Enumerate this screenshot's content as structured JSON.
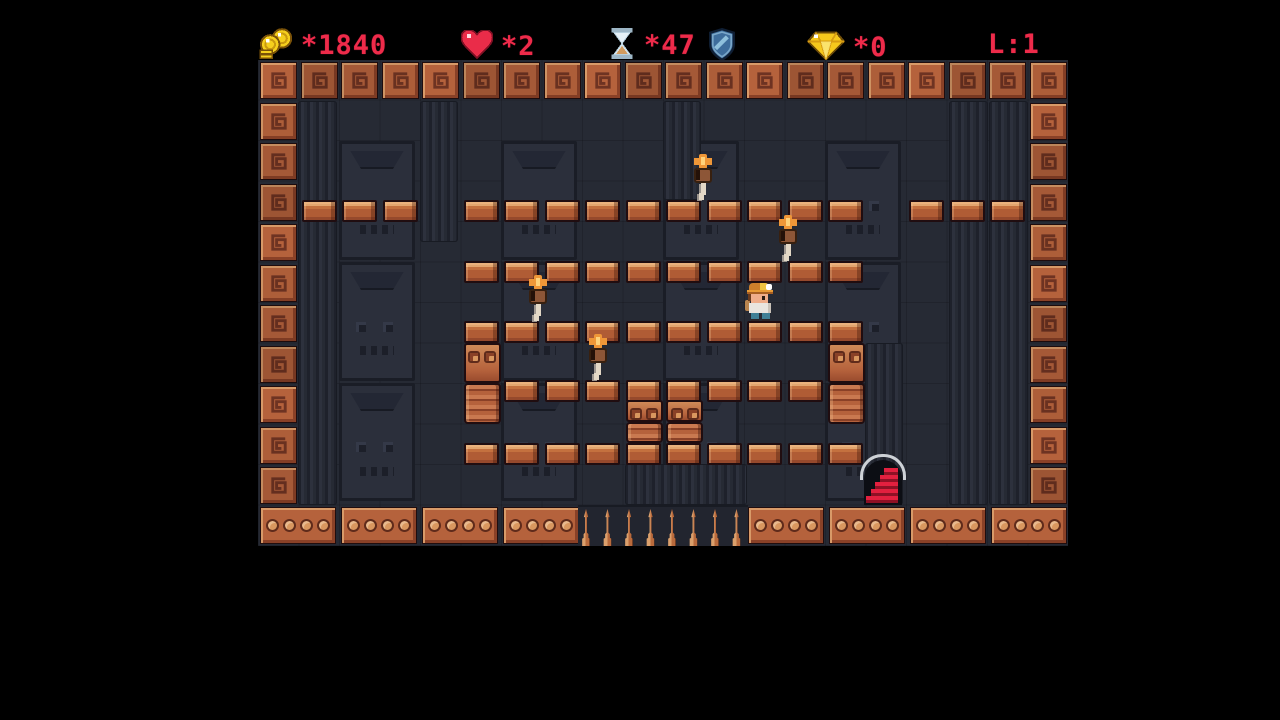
{
  "title": "temple platformer level screen",
  "hud": {
    "coins": {
      "icon": "coins-icon",
      "value": "*1840"
    },
    "lives": {
      "icon": "heart-icon",
      "value": "*2"
    },
    "time": {
      "icon": "hourglass-icon",
      "value": "*47"
    },
    "shield": {
      "icon": "shield-icon"
    },
    "gems": {
      "icon": "gem-icon",
      "value": "*0"
    },
    "level": {
      "label": "L:1"
    }
  },
  "colors": {
    "hud_text": "#ee2b4a",
    "tile_orange": "#b5623c",
    "tile_light": "#d89a68",
    "tile_dark": "#8a4127",
    "wall": "#262a34",
    "wall_panel": "#2b2f3b",
    "wall_line": "#1a1d26",
    "brick": "#b05c35",
    "brick_top": "#e3a56e",
    "flame_orange": "#ef9738",
    "stairs_red": "#e2203f",
    "arc_gray": "#cdd1d6",
    "player_hat": "#cd7f2b",
    "player_pants": "#3f8096",
    "coin_gold": "#f5cf1d",
    "shield_blue": "#3e6d9c",
    "glass_blue": "#dcebf4",
    "sand": "#d29b5e"
  },
  "level": {
    "grid": {
      "cols": 20,
      "rows": 12,
      "tile": 40.5,
      "field_x": 258,
      "field_y": 60,
      "field_w": 810,
      "field_h": 486
    },
    "platforms": [
      {
        "y": 140,
        "cols": [
          1,
          2,
          3,
          5,
          6,
          7,
          8,
          9,
          10,
          11,
          12,
          13,
          14,
          16,
          17,
          18
        ]
      },
      {
        "y": 201,
        "cols": [
          5,
          6,
          7,
          8,
          9,
          10,
          11,
          12,
          13,
          14
        ]
      },
      {
        "y": 261,
        "cols": [
          5,
          6,
          7,
          8,
          9,
          10,
          11,
          12,
          13,
          14
        ]
      },
      {
        "y": 320,
        "cols": [
          6,
          7,
          8,
          9,
          10,
          11,
          12,
          13
        ]
      },
      {
        "y": 383,
        "cols": [
          5,
          6,
          7,
          8,
          9,
          10,
          11,
          12,
          13,
          14
        ]
      }
    ],
    "totems": [
      {
        "col": 5,
        "y": 283,
        "eye_h": 40,
        "rib_h": 41
      },
      {
        "col": 14,
        "y": 283,
        "eye_h": 40,
        "rib_h": 41
      },
      {
        "col": 9,
        "y": 340,
        "eye_h": 22,
        "rib_h": 21
      },
      {
        "col": 10,
        "y": 340,
        "eye_h": 22,
        "rib_h": 21
      }
    ],
    "torches": [
      {
        "x": 431,
        "y": 94
      },
      {
        "x": 516,
        "y": 155
      },
      {
        "x": 266,
        "y": 215
      },
      {
        "x": 326,
        "y": 274
      }
    ],
    "player": {
      "x": 487,
      "y": 223,
      "facing": "right"
    },
    "exit": {
      "x": 598,
      "y": 394,
      "steps": 5
    },
    "spikes": {
      "x": 322,
      "y": 449,
      "count": 8,
      "pitch": 21.5
    },
    "wall": {
      "pillars": [
        {
          "x": 40,
          "y": 41,
          "w": 39,
          "h": 404
        },
        {
          "x": 162,
          "y": 41,
          "w": 38,
          "h": 141
        },
        {
          "x": 405,
          "y": 41,
          "w": 38,
          "h": 99
        },
        {
          "x": 691,
          "y": 41,
          "w": 39,
          "h": 404
        },
        {
          "x": 731,
          "y": 41,
          "w": 39,
          "h": 404
        },
        {
          "x": 607,
          "y": 283,
          "w": 38,
          "h": 162
        },
        {
          "x": 367,
          "y": 404,
          "w": 122,
          "h": 41
        }
      ],
      "panels": [
        {
          "x": 81,
          "y": 81,
          "w": 76,
          "h": 119
        },
        {
          "x": 243,
          "y": 81,
          "w": 76,
          "h": 119
        },
        {
          "x": 405,
          "y": 81,
          "w": 76,
          "h": 119
        },
        {
          "x": 567,
          "y": 81,
          "w": 76,
          "h": 119
        },
        {
          "x": 81,
          "y": 202,
          "w": 76,
          "h": 119
        },
        {
          "x": 243,
          "y": 202,
          "w": 76,
          "h": 119
        },
        {
          "x": 405,
          "y": 202,
          "w": 76,
          "h": 119
        },
        {
          "x": 567,
          "y": 202,
          "w": 76,
          "h": 119
        },
        {
          "x": 81,
          "y": 323,
          "w": 76,
          "h": 118
        },
        {
          "x": 243,
          "y": 323,
          "w": 76,
          "h": 118
        },
        {
          "x": 405,
          "y": 323,
          "w": 76,
          "h": 118
        },
        {
          "x": 567,
          "y": 323,
          "w": 76,
          "h": 118
        }
      ]
    }
  }
}
